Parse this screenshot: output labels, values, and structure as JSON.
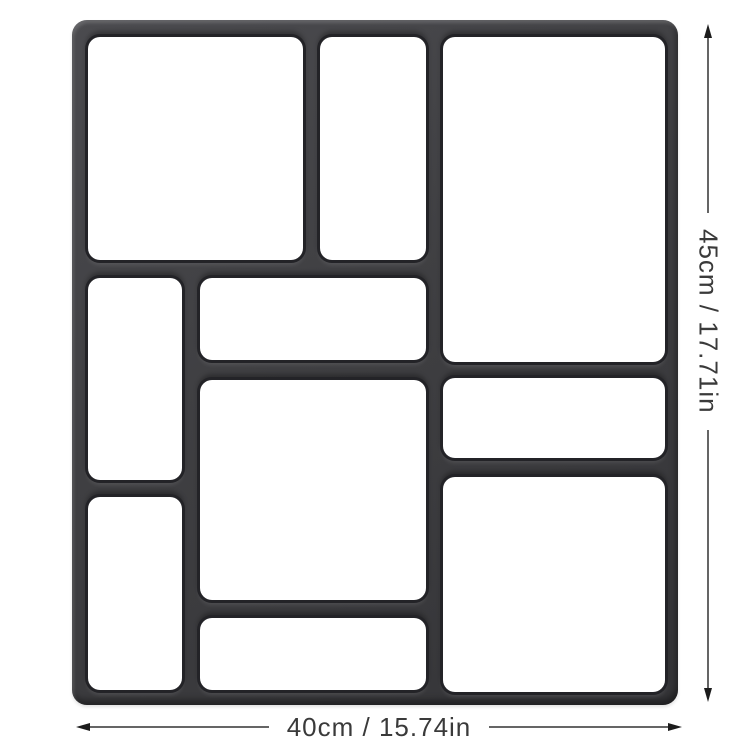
{
  "product": {
    "description": "paver-mold-diagram",
    "cavity_count": 10
  },
  "dimensions": {
    "width_label": "40cm / 15.74in",
    "height_label": "45cm / 17.71in"
  },
  "colors": {
    "background": "#ffffff",
    "mold_body": "#3f3f42",
    "mold_body_light": "#4b4b4f",
    "mold_body_dark": "#343437",
    "cavity_ring": "#232327",
    "cavity_fill": "#ffffff",
    "annotation_line": "#4a4a4a",
    "annotation_arrow": "#1c1c1c",
    "annotation_text": "#3a3a3a"
  }
}
